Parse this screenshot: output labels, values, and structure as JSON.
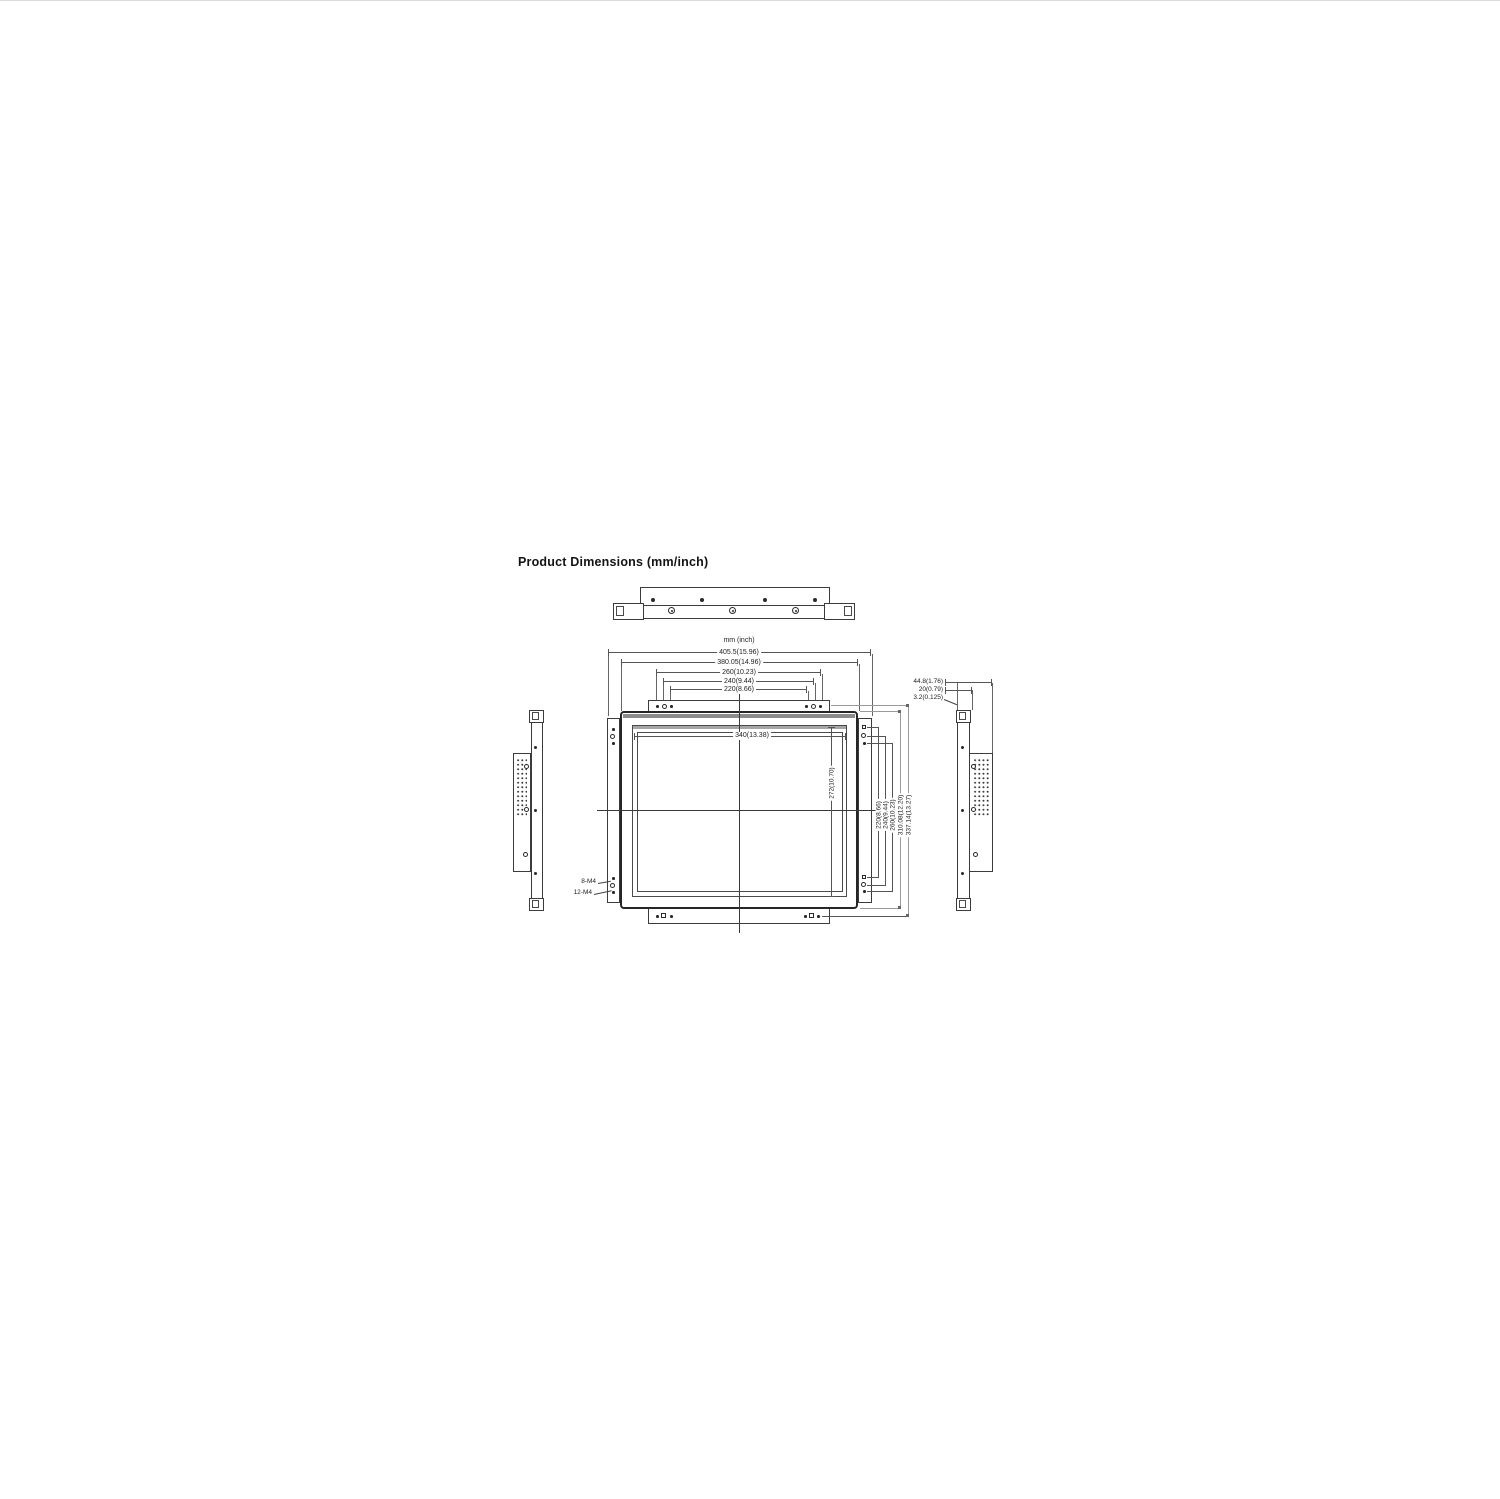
{
  "title": "Product Dimensions (mm/inch)",
  "unit_note": "mm (inch)",
  "front": {
    "width_dims": [
      "405.5(15.96)",
      "380.05(14.96)",
      "260(10.23)",
      "240(9.44)",
      "220(8.66)"
    ],
    "height_dims": [
      "220(8.66)",
      "240(9.44)",
      "260(10.23)",
      "310.08(12.20)",
      "337.14(13.27)"
    ],
    "active_area": {
      "width": "340(13.38)",
      "height": "272(10.70)"
    },
    "hole_callouts": [
      "8-M4",
      "12-M4"
    ]
  },
  "side": {
    "depth_dims": [
      "44.8(1.76)",
      "20(0.79)",
      "3.2(0.125)"
    ]
  },
  "colors": {
    "line": "#3c3c3c",
    "dim_line": "#555555",
    "light_line": "#9a9a9a",
    "bezel_band": "#8c8c8c",
    "background": "#ffffff"
  }
}
